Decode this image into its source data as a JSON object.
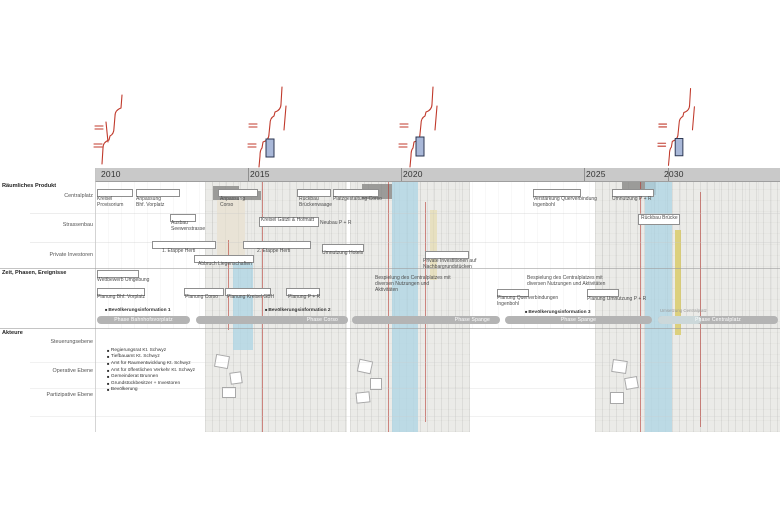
{
  "timeline": {
    "years": [
      "2010",
      "2015",
      "2020",
      "2025",
      "2030"
    ]
  },
  "left_rail": {
    "sections": [
      {
        "title": "Räumliches Produkt",
        "rows": [
          "Centralplatz",
          "Strassenbau",
          "Private Investoren"
        ]
      },
      {
        "title": "Zeit, Phasen, Ereignisse",
        "rows": []
      },
      {
        "title": "Akteure",
        "rows": [
          "Steuerungsebene",
          "Operative Ebene",
          "Partizipative Ebene"
        ]
      }
    ]
  },
  "annotations": {
    "kreisel_provisorium": "Kreisel\nProvisorium",
    "anpassung_bhf": "Anpassung\nBhf. Vorplatz",
    "anpassung_corso": "Anpassung\nCorso",
    "rueckbau_brueckenwaage": "Rückbau\nBrückenwaage",
    "platzgestaltung_corso": "Platzgestaltung Corso",
    "verstaerkung_querverbindung": "Verstärkung Querverbindung\nIngenbohl",
    "umnutzung_pr": "Umnutzung P + R",
    "ausbau_seewenstrasse": "Ausbau\nSeewenstrasse",
    "kreisel_gaetzli": "Kreisel Gätzli & Hofmatt",
    "neubau_pr": "Neubau P + R",
    "rueckbau_bruecke": "Rückbau Brücke",
    "etappe1": "1. Etappe Herti",
    "etappe2": "2. Etappe Herti",
    "abbruch_liegenschaften": "Abbruch Liegenschaften",
    "umnutzung_hotels": "Umnutzung Hotels",
    "private_investitionen": "Private Investitionen auf\nNachbargrundstücken",
    "wettbewerb": "Wettbewerb Umgebung",
    "planung_bhf": "Planung Bhf. Vorplatz",
    "planung_corso": "Planung Corso",
    "planung_gbh": "Planung Kreisel GBH",
    "planung_pr": "Planung P + R",
    "bespielung1": "Bespielung des Centralplatzes mit\ndiversen Nutzungen und Aktivitäten",
    "bespielung2": "Bespielung des Centralplatzes mit\ndiversen Nutzungen und Aktivitäten",
    "planung_querverbindungen": "Planung Querverbindungen\nIngenbohl",
    "planung_umnutzung_pr": "Planung Umnutzung P + R"
  },
  "events": {
    "e1": "Bevölkerungsinformation 1",
    "e2": "Bevölkerungsinformation 2",
    "e3": "Bevölkerungsinformation 3"
  },
  "phases": {
    "p1": "Phase Bahnhofsvorplatz",
    "p2": "Phase Corso",
    "p3": "Phase Spange",
    "p4": "Phase Spange",
    "p5": "Phase Centralplatz",
    "p5_caption": "Umsetzung Centralplatz"
  },
  "actors": [
    "Regierungsrat Kt. Schwyz",
    "Tiefbauamt Kt. Schwyz",
    "Amt für Raumentwicklung Kt. Schwyz",
    "Amt für öffentlichen Verkehr Kt. Schwyz",
    "Gemeinderat Brunnen",
    "Grundstückbesitzer + Investoren",
    "Bevölkerung"
  ],
  "icons": {
    "event_marker": "■",
    "actor_bullet": "■"
  },
  "colors": {
    "accent_red": "#c0392b",
    "water_blue": "#b0d6e4",
    "phase_gray": "#b4b4b4",
    "header_band": "#c9c9c9",
    "sketch_fill": "#a9b8d8"
  }
}
